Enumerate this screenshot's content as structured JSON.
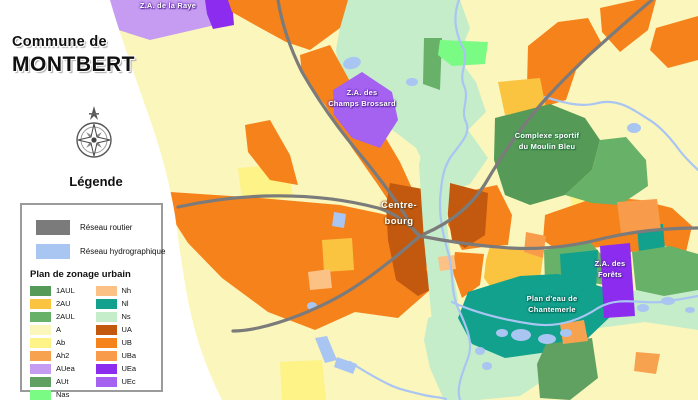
{
  "header": {
    "title_line1": "Commune de",
    "title_line2": "MONTBERT",
    "legend_heading": "Légende"
  },
  "legend": {
    "networks": [
      {
        "label": "Réseau routier",
        "color": "#7b7b7b"
      },
      {
        "label": "Réseau hydrographique",
        "color": "#a9c5f2"
      }
    ],
    "zoning_title": "Plan de zonage urbain",
    "zoning_col1": [
      {
        "code": "1AUL",
        "color": "#569a57"
      },
      {
        "code": "2AU",
        "color": "#fbc440"
      },
      {
        "code": "2AUL",
        "color": "#68b169"
      },
      {
        "code": "A",
        "color": "#fbf6bb"
      },
      {
        "code": "Ab",
        "color": "#fdf387"
      },
      {
        "code": "Ah2",
        "color": "#f6a24f"
      },
      {
        "code": "AUea",
        "color": "#c69cf2"
      },
      {
        "code": "AUt",
        "color": "#60a161"
      },
      {
        "code": "Nas",
        "color": "#7afb84"
      }
    ],
    "zoning_col2": [
      {
        "code": "Nh",
        "color": "#fbc185"
      },
      {
        "code": "Nl",
        "color": "#11a18c"
      },
      {
        "code": "Ns",
        "color": "#c5edca"
      },
      {
        "code": "UA",
        "color": "#c2590e"
      },
      {
        "code": "UB",
        "color": "#f6821c"
      },
      {
        "code": "UBa",
        "color": "#f89c4b"
      },
      {
        "code": "UEa",
        "color": "#8c2cee"
      },
      {
        "code": "UEc",
        "color": "#a561f0"
      }
    ]
  },
  "map": {
    "colors": {
      "road": "#7b7b7b",
      "water": "#a9c5f2",
      "A": "#fbf6bb",
      "Ab": "#fdf387",
      "Ah2": "#f6a24f",
      "AUea": "#c69cf2",
      "AUt": "#60a161",
      "Nas": "#7afb84",
      "Nh": "#fbc185",
      "Nl": "#11a18c",
      "Ns": "#c5edca",
      "UA": "#c2590e",
      "UB": "#f6821c",
      "UBa": "#f89c4b",
      "UEa": "#8c2cee",
      "UEc": "#a561f0",
      "oneAUL": "#569a57",
      "twoAU": "#fbc440",
      "twoAUL": "#68b169",
      "panel": "#ffffff"
    },
    "labels": {
      "raye": {
        "line1": "Z.A. de la Raye",
        "line2": ""
      },
      "brossard": {
        "line1": "Z.A. des",
        "line2": "Champs Brossard"
      },
      "moulin": {
        "line1": "Complexe sportif",
        "line2": "du Moulin Bleu"
      },
      "bourg": {
        "line1": "Centre-",
        "line2": "bourg"
      },
      "forets": {
        "line1": "Z.A. des",
        "line2": "Forêts"
      },
      "chantemerle": {
        "line1": "Plan d'eau de",
        "line2": "Chantemerle"
      }
    }
  }
}
